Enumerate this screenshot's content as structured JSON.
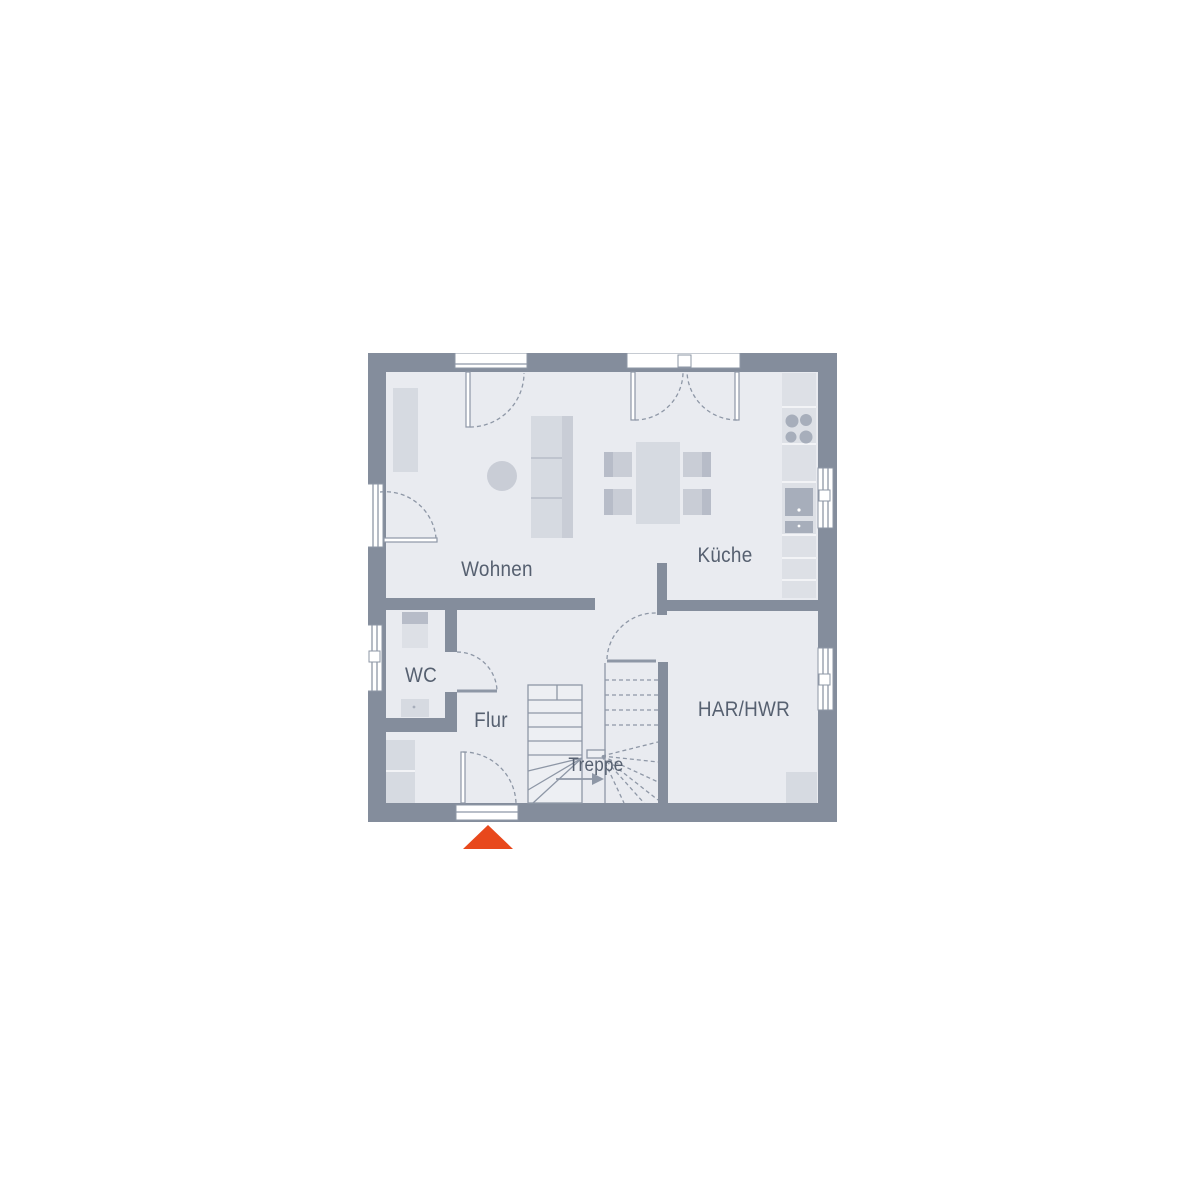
{
  "colors": {
    "background": "#ffffff",
    "white": "#ffffff",
    "wall": "#848d9c",
    "floor": "#e9ebf0",
    "stair_fill": "#edeff3",
    "furniture": "#d6dae1",
    "furniture_dark": "#c9cdd6",
    "furniture_shadow": "#b7bcc8",
    "counter": "#dde0e6",
    "appliance": "#a7aebb",
    "line": "#8e97a6",
    "label": "#566070",
    "accent": "#e8481c"
  },
  "rooms": [
    {
      "id": "wohnen",
      "label": "Wohnen"
    },
    {
      "id": "kueche",
      "label": "Küche"
    },
    {
      "id": "wc",
      "label": "WC"
    },
    {
      "id": "flur",
      "label": "Flur"
    },
    {
      "id": "treppe",
      "label": "Treppe"
    },
    {
      "id": "har_hwr",
      "label": "HAR/HWR"
    }
  ],
  "icons": {
    "entrance_arrow": "up-triangle"
  }
}
